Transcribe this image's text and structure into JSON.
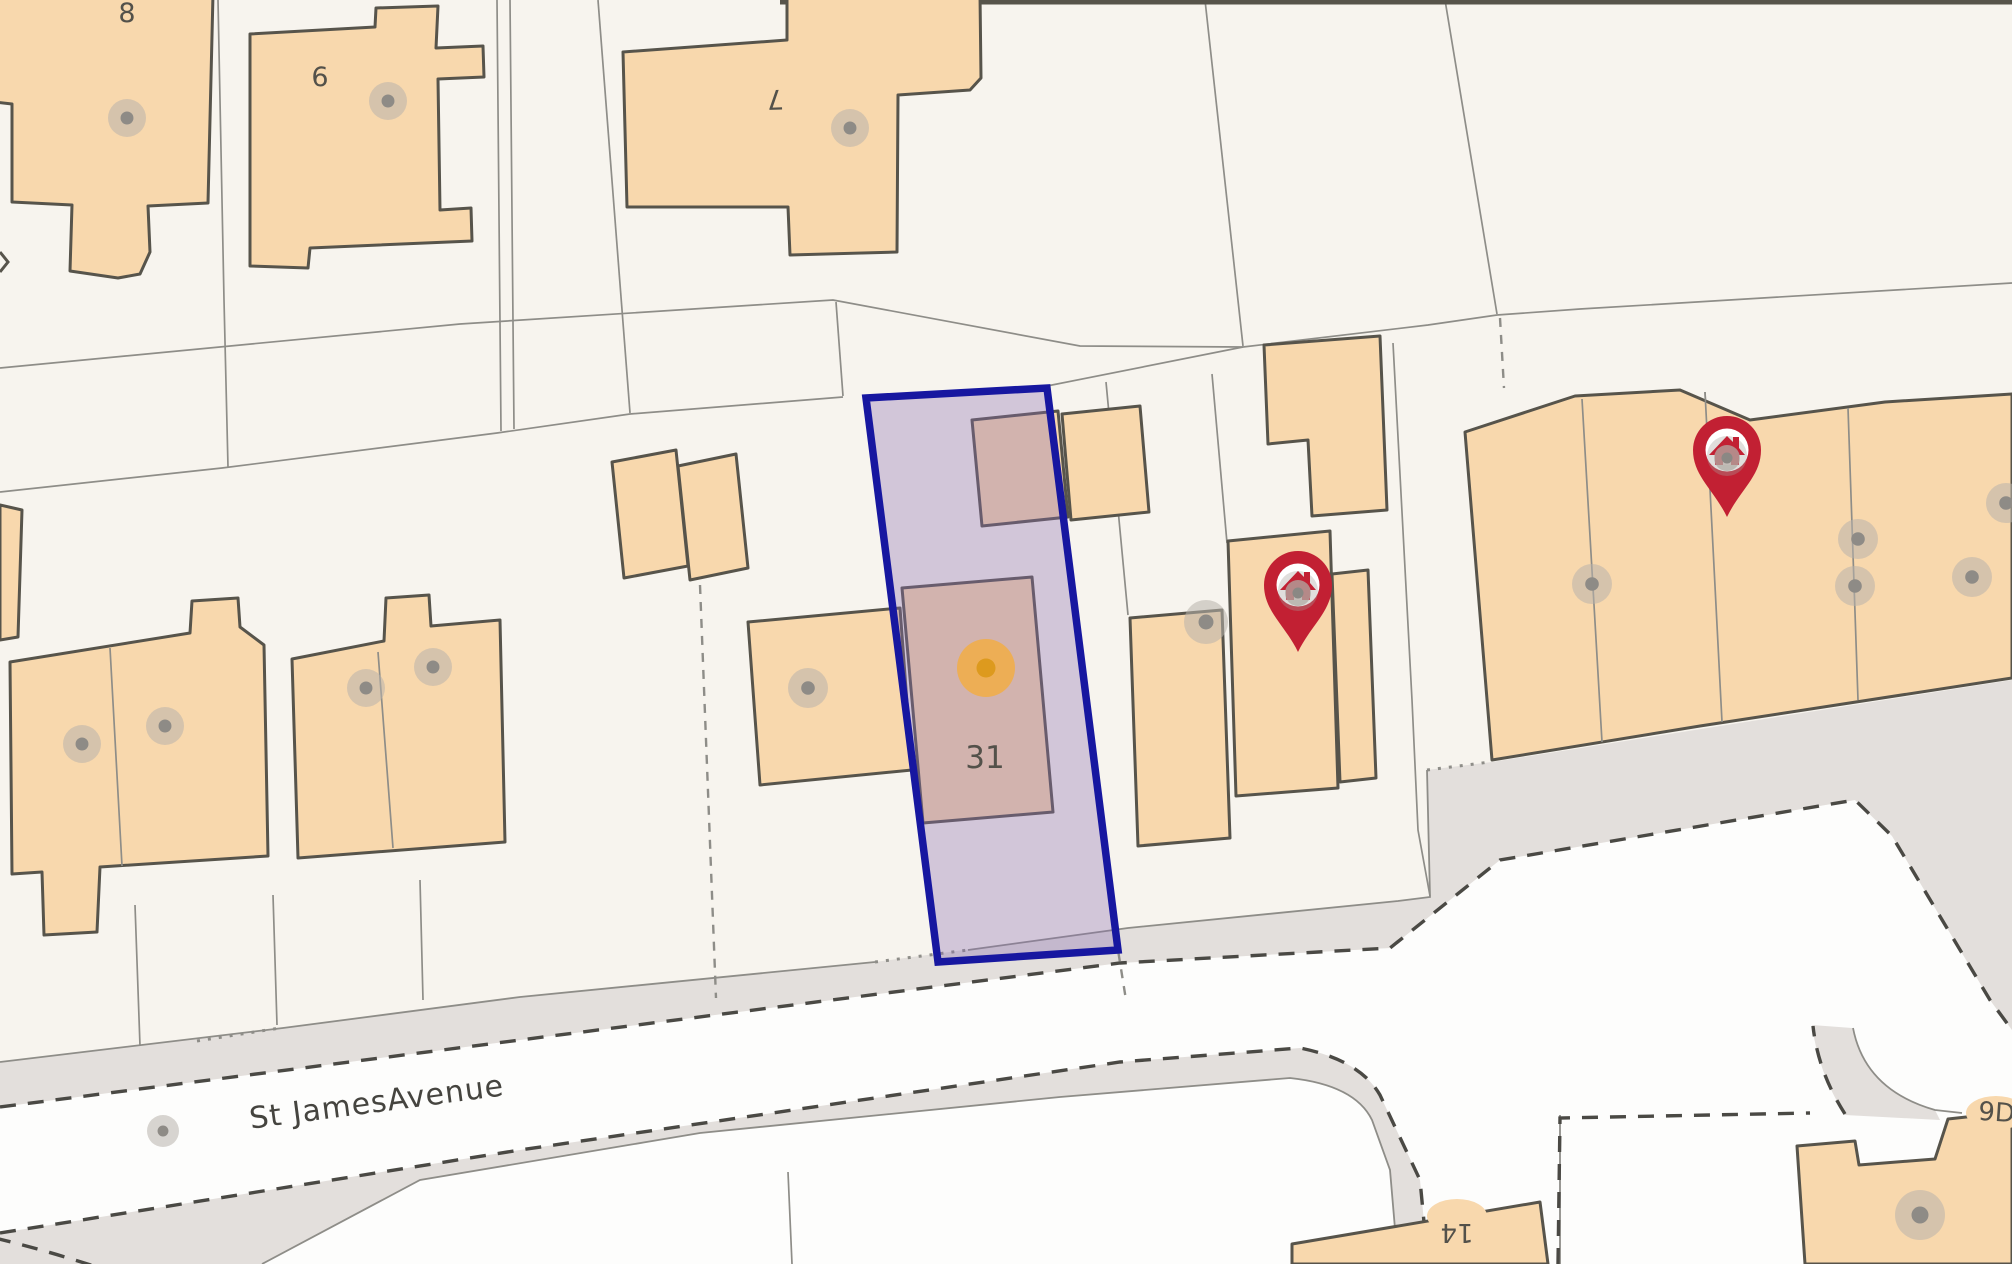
{
  "map": {
    "street_label": {
      "text": "St JamesAvenue",
      "x": 378,
      "y": 1112,
      "rotation": -7.5,
      "size": 30
    },
    "plot_labels": [
      {
        "text": "8",
        "x": 127,
        "y": 22,
        "rotation": 0,
        "size": 27,
        "halo": false
      },
      {
        "text": "6",
        "x": 320,
        "y": 86,
        "rotation": 0,
        "size": 27,
        "halo": false
      },
      {
        "text": "7",
        "x": 775,
        "y": 90,
        "rotation": 178,
        "size": 27,
        "halo": false
      },
      {
        "text": "31",
        "x": 985,
        "y": 768,
        "rotation": 0,
        "size": 31,
        "halo": false
      },
      {
        "text": "14",
        "x": 1457,
        "y": 1224,
        "rotation": 180,
        "size": 26,
        "halo": true
      },
      {
        "text": "9D",
        "x": 1996,
        "y": 1121,
        "rotation": 4,
        "size": 26,
        "halo": true
      }
    ],
    "selected_plot": {
      "label": "31",
      "border_color": "#1717a0",
      "fill_color": "rgba(138,108,176,0.34)"
    },
    "selected_marker": {
      "x": 986,
      "y": 668,
      "halo_color": "#f0ad4b",
      "core_color": "#dd9a1e"
    },
    "house_pins": [
      {
        "x": 1298,
        "y": 585
      },
      {
        "x": 1727,
        "y": 450
      }
    ],
    "pin_color": "#c22033",
    "building_dots": [
      {
        "x": 127,
        "y": 118,
        "r": 19
      },
      {
        "x": 388,
        "y": 101,
        "r": 19
      },
      {
        "x": 850,
        "y": 128,
        "r": 19
      },
      {
        "x": 82,
        "y": 744,
        "r": 19
      },
      {
        "x": 165,
        "y": 726,
        "r": 19
      },
      {
        "x": 366,
        "y": 688,
        "r": 19
      },
      {
        "x": 433,
        "y": 667,
        "r": 19
      },
      {
        "x": 808,
        "y": 688,
        "r": 20
      },
      {
        "x": 1206,
        "y": 622,
        "r": 22
      },
      {
        "x": 1592,
        "y": 584,
        "r": 20
      },
      {
        "x": 1858,
        "y": 539,
        "r": 20
      },
      {
        "x": 1855,
        "y": 586,
        "r": 20
      },
      {
        "x": 1972,
        "y": 577,
        "r": 20
      },
      {
        "x": 2006,
        "y": 503,
        "r": 20
      },
      {
        "x": 163,
        "y": 1131,
        "r": 16
      },
      {
        "x": 1920,
        "y": 1215,
        "r": 25
      }
    ],
    "colors": {
      "background": "#f7f4ee",
      "building_fill": "#f8d8ad",
      "building_stroke": "#57544b",
      "parcel_line": "#8e8d88",
      "road_surface": "#fdfdfc",
      "verge": "#e3dfdc",
      "road_edge_dash": "#4a4944",
      "dot_halo": "#b8b3ac",
      "dot_core": "#8e8b86",
      "label_color": "#53514a"
    }
  }
}
